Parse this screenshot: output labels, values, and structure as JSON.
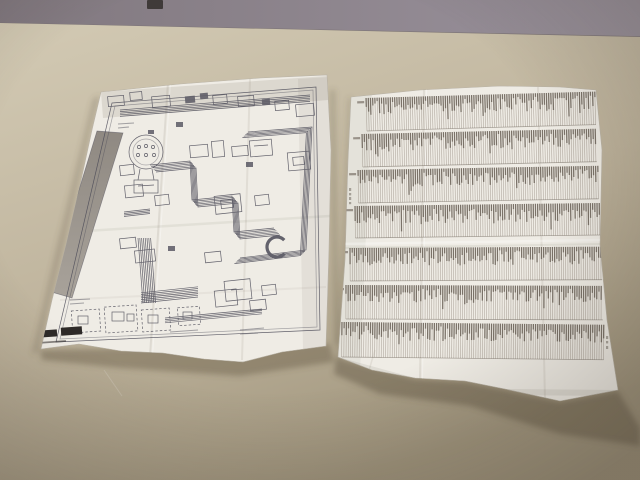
{
  "colors": {
    "wall_left": "#81787f",
    "wall_right": "#9a929c",
    "horizon": "#6e6560",
    "desk_top": "#d1c8b2",
    "desk_mid": "#beb39c",
    "desk_bottom": "#a0957d",
    "shadow": "#5f5440",
    "paper_face": "#efece5",
    "paper_shade": "#c9c4ba",
    "ink": "#4b4a57",
    "strip_gray": "#9a948c",
    "print_hairline": "#9d948a",
    "print_dark": "#675e54",
    "black_mark": "#2e2a28",
    "wall_object": "#3f3a39"
  },
  "left_paper": {
    "kind": "folded schematic wiring diagram sheet",
    "black_marks": 2,
    "dashed_modules": 4
  },
  "right_paper": {
    "kind": "folded dot-matrix printout sheet",
    "band_count": 7,
    "stripe_step": 2.2,
    "bands": [
      {
        "x": 366,
        "y": 96,
        "w": 229,
        "h": 35,
        "rot": -1.6
      },
      {
        "x": 362,
        "y": 132,
        "w": 234,
        "h": 35,
        "rot": -1.3
      },
      {
        "x": 358,
        "y": 168,
        "w": 240,
        "h": 35,
        "rot": -1.0
      },
      {
        "x": 355,
        "y": 204,
        "w": 245,
        "h": 34,
        "rot": -0.7
      },
      {
        "x": 350,
        "y": 246,
        "w": 252,
        "h": 35,
        "rot": -0.3
      },
      {
        "x": 346,
        "y": 283,
        "w": 257,
        "h": 36,
        "rot": 0.2
      },
      {
        "x": 342,
        "y": 320,
        "w": 262,
        "h": 37,
        "rot": 0.6
      }
    ]
  }
}
